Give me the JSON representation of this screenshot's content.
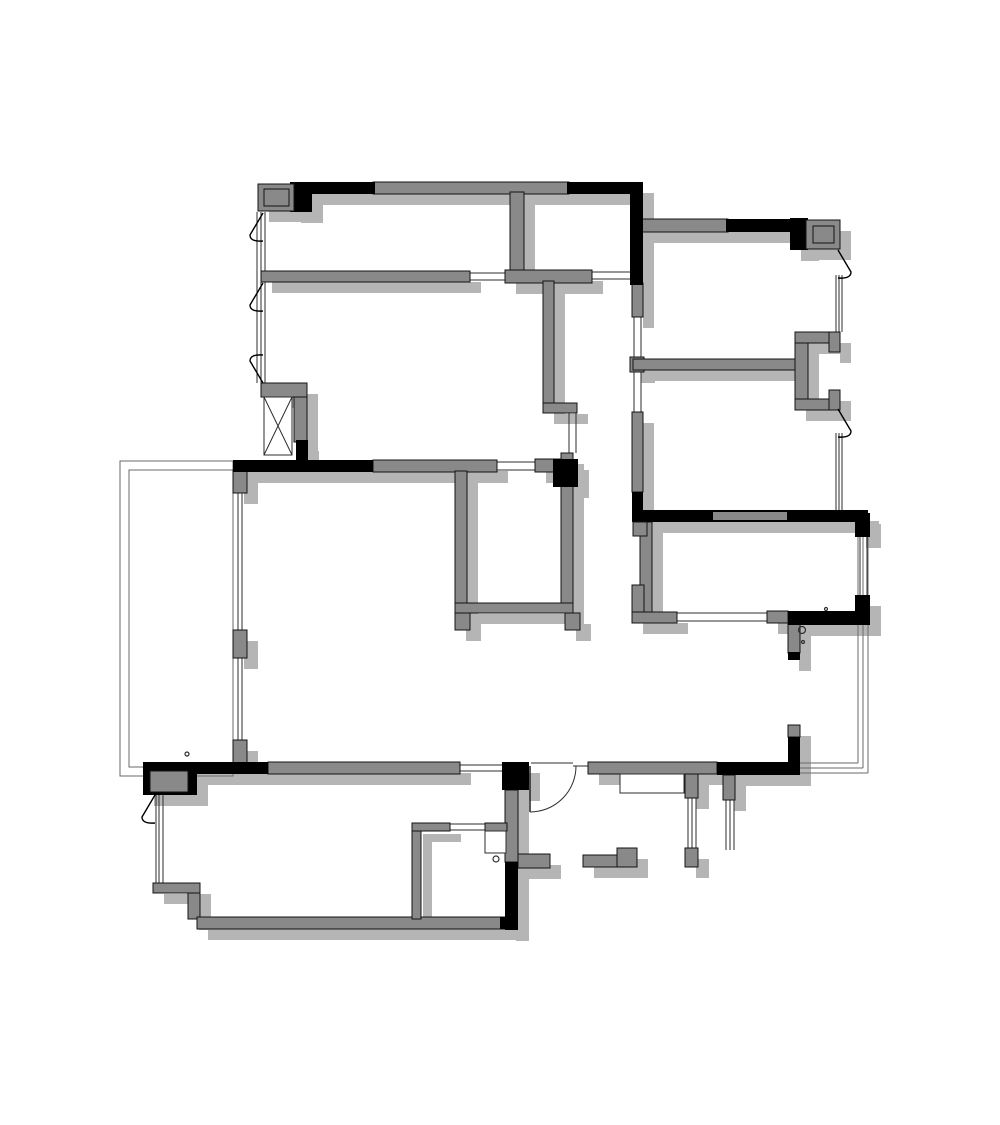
{
  "canvas": {
    "width": 1000,
    "height": 1125,
    "background": "#ffffff"
  },
  "palette": {
    "wall_gray": "#898989",
    "wall_black": "#000000",
    "wall_outline": "#141414",
    "shadow": "#b5b5b5",
    "thin_line": "#2e2e2e",
    "balcony_line": "#6a6a6a",
    "fixture_fill": "#ffffff"
  },
  "shadow_offset": {
    "dx": 11,
    "dy": 11
  },
  "walls_gray": [
    [
      373,
      182,
      196,
      12
    ],
    [
      641,
      219,
      87,
      13
    ],
    [
      261,
      271,
      209,
      11
    ],
    [
      510,
      192,
      14,
      80
    ],
    [
      505,
      270,
      87,
      13
    ],
    [
      543,
      281,
      11,
      124
    ],
    [
      543,
      403,
      34,
      10
    ],
    [
      632,
      283,
      11,
      34
    ],
    [
      630,
      357,
      14,
      15
    ],
    [
      633,
      359,
      167,
      11
    ],
    [
      795,
      332,
      13,
      78
    ],
    [
      795,
      332,
      45,
      11
    ],
    [
      829,
      332,
      11,
      20
    ],
    [
      795,
      399,
      45,
      11
    ],
    [
      829,
      390,
      11,
      20
    ],
    [
      632,
      412,
      11,
      80
    ],
    [
      640,
      522,
      12,
      90
    ],
    [
      632,
      585,
      12,
      38
    ],
    [
      632,
      612,
      45,
      11
    ],
    [
      767,
      611,
      21,
      12
    ],
    [
      788,
      623,
      12,
      30
    ],
    [
      788,
      725,
      12,
      12
    ],
    [
      373,
      460,
      124,
      12
    ],
    [
      535,
      459,
      38,
      13
    ],
    [
      455,
      471,
      12,
      132
    ],
    [
      561,
      453,
      12,
      150
    ],
    [
      455,
      603,
      118,
      10
    ],
    [
      455,
      613,
      15,
      17
    ],
    [
      565,
      613,
      15,
      17
    ],
    [
      233,
      470,
      14,
      23
    ],
    [
      233,
      630,
      14,
      28
    ],
    [
      233,
      740,
      14,
      23
    ],
    [
      268,
      762,
      192,
      12
    ],
    [
      588,
      762,
      129,
      12
    ],
    [
      685,
      774,
      13,
      24
    ],
    [
      685,
      848,
      13,
      19
    ],
    [
      723,
      775,
      12,
      25
    ],
    [
      153,
      883,
      47,
      10
    ],
    [
      188,
      893,
      12,
      26
    ],
    [
      197,
      917,
      320,
      12
    ],
    [
      505,
      790,
      13,
      72
    ],
    [
      412,
      823,
      9,
      96
    ],
    [
      412,
      823,
      38,
      8
    ],
    [
      485,
      823,
      22,
      8
    ],
    [
      518,
      854,
      32,
      14
    ],
    [
      583,
      855,
      34,
      12
    ],
    [
      617,
      848,
      20,
      19
    ],
    [
      261,
      383,
      46,
      14
    ],
    [
      294,
      397,
      13,
      45
    ]
  ],
  "walls_black": [
    [
      290,
      182,
      22,
      30
    ],
    [
      295,
      182,
      80,
      12
    ],
    [
      567,
      182,
      76,
      12
    ],
    [
      630,
      192,
      13,
      93
    ],
    [
      726,
      219,
      82,
      13
    ],
    [
      790,
      218,
      18,
      32
    ],
    [
      632,
      492,
      11,
      20
    ],
    [
      632,
      510,
      236,
      12
    ],
    [
      855,
      513,
      15,
      24
    ],
    [
      855,
      595,
      15,
      30
    ],
    [
      788,
      611,
      80,
      14
    ],
    [
      788,
      652,
      12,
      8
    ],
    [
      788,
      737,
      12,
      38
    ],
    [
      233,
      460,
      140,
      12
    ],
    [
      553,
      459,
      25,
      28
    ],
    [
      143,
      762,
      54,
      33
    ],
    [
      188,
      762,
      80,
      12
    ],
    [
      502,
      762,
      27,
      28
    ],
    [
      717,
      762,
      83,
      13
    ],
    [
      296,
      440,
      12,
      20
    ],
    [
      500,
      917,
      17,
      12
    ],
    [
      505,
      862,
      13,
      68
    ]
  ],
  "wall_inset_gray": [
    [
      713,
      512,
      74,
      8
    ]
  ],
  "columns": [
    {
      "outer": [
        258,
        184,
        36,
        27
      ],
      "inner": [
        264,
        189,
        25,
        17
      ]
    },
    {
      "outer": [
        806,
        220,
        34,
        29
      ],
      "inner": [
        813,
        226,
        21,
        17
      ]
    },
    {
      "outer": [
        150,
        771,
        38,
        21
      ],
      "inner": null
    },
    {
      "outer": [
        633,
        522,
        14,
        14
      ],
      "inner": null
    }
  ],
  "shaft_box": [
    264,
    397,
    28,
    58
  ],
  "fixture_rects": [
    [
      620,
      774,
      64,
      19
    ],
    [
      485,
      831,
      21,
      22
    ]
  ],
  "balcony_rects": [
    [
      120,
      461,
      113,
      315
    ],
    [
      129,
      470,
      104,
      297
    ]
  ],
  "thin_lines": [
    [
      470,
      273,
      505,
      273
    ],
    [
      470,
      280,
      505,
      280
    ],
    [
      592,
      272,
      630,
      272
    ],
    [
      592,
      279,
      630,
      279
    ],
    [
      677,
      613,
      768,
      613
    ],
    [
      677,
      621,
      768,
      621
    ],
    [
      460,
      765,
      502,
      765
    ],
    [
      460,
      771,
      502,
      771
    ],
    [
      450,
      824,
      485,
      824
    ],
    [
      450,
      830,
      485,
      830
    ],
    [
      573,
      766,
      589,
      766
    ],
    [
      531,
      763,
      573,
      763
    ],
    [
      497,
      462,
      535,
      462
    ],
    [
      497,
      470,
      535,
      470
    ],
    [
      257,
      212,
      257,
      383
    ],
    [
      261,
      212,
      261,
      383
    ],
    [
      265,
      212,
      265,
      383
    ],
    [
      836,
      275,
      836,
      332
    ],
    [
      839,
      275,
      839,
      332
    ],
    [
      842,
      275,
      842,
      332
    ],
    [
      836,
      433,
      836,
      513
    ],
    [
      839,
      433,
      839,
      513
    ],
    [
      842,
      433,
      842,
      513
    ],
    [
      860,
      537,
      860,
      597
    ],
    [
      863,
      537,
      863,
      597
    ],
    [
      867,
      537,
      867,
      597
    ],
    [
      688,
      798,
      688,
      848
    ],
    [
      692,
      798,
      692,
      848
    ],
    [
      696,
      798,
      696,
      848
    ],
    [
      726,
      800,
      726,
      850
    ],
    [
      730,
      800,
      730,
      850
    ],
    [
      734,
      800,
      734,
      850
    ],
    [
      156,
      795,
      156,
      883
    ],
    [
      159,
      795,
      159,
      883
    ],
    [
      163,
      795,
      163,
      883
    ],
    [
      635,
      194,
      635,
      219
    ],
    [
      638,
      194,
      638,
      219
    ],
    [
      641,
      194,
      641,
      219
    ],
    [
      238,
      493,
      238,
      632
    ],
    [
      242,
      493,
      242,
      632
    ],
    [
      238,
      658,
      238,
      740
    ],
    [
      242,
      658,
      242,
      740
    ],
    [
      569,
      413,
      569,
      453
    ],
    [
      576,
      413,
      576,
      453
    ],
    [
      634,
      317,
      634,
      358
    ],
    [
      641,
      317,
      641,
      358
    ],
    [
      634,
      372,
      634,
      412
    ],
    [
      641,
      372,
      641,
      412
    ]
  ],
  "balcony_lines": [
    [
      858,
      537,
      858,
      763
    ],
    [
      863,
      537,
      863,
      768
    ],
    [
      868,
      537,
      868,
      773
    ],
    [
      800,
      763,
      858,
      763
    ],
    [
      800,
      768,
      863,
      768
    ],
    [
      800,
      773,
      868,
      773
    ]
  ],
  "door_arcs": [
    {
      "path": "M 530 812 A 46 46 0 0 0 576 766"
    }
  ],
  "door_leaves": [
    [
      530,
      766,
      530,
      812
    ]
  ],
  "window_flags": [
    {
      "x": 263,
      "y": 213,
      "type": "left"
    },
    {
      "x": 263,
      "y": 283,
      "type": "left"
    },
    {
      "x": 263,
      "y": 383,
      "type": "left-up"
    },
    {
      "x": 155,
      "y": 795,
      "type": "left"
    },
    {
      "x": 838,
      "y": 250,
      "type": "right"
    },
    {
      "x": 838,
      "y": 409,
      "type": "right"
    }
  ],
  "circles": [
    [
      802,
      630,
      3.5
    ],
    [
      803,
      642,
      1.5
    ],
    [
      496,
      859,
      3
    ],
    [
      187,
      754,
      2
    ],
    [
      826,
      609,
      1.5
    ]
  ]
}
